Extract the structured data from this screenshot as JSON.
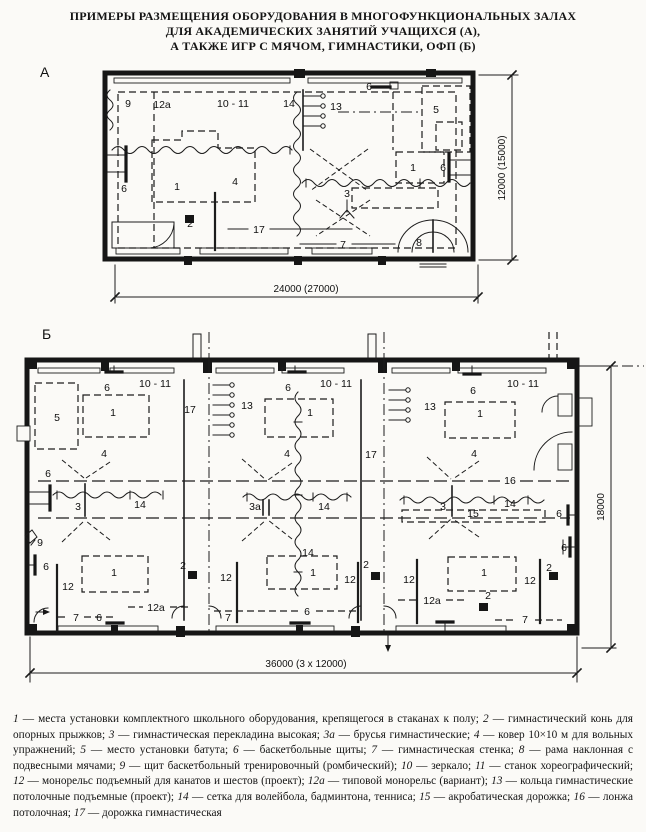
{
  "colors": {
    "ink": "#1c1c1c",
    "paper": "#fbfaf7"
  },
  "title": {
    "line1": "ПРИМЕРЫ РАЗМЕЩЕНИЯ ОБОРУДОВАНИЯ В МНОГОФУНКЦИОНАЛЬНЫХ ЗАЛАХ",
    "line2": "ДЛЯ АКАДЕМИЧЕСКИХ ЗАНЯТИЙ УЧАЩИХСЯ (А),",
    "line3": "А ТАКЖЕ ИГР С МЯЧОМ, ГИМНАСТИКИ, ОФП (Б)"
  },
  "plan_a": {
    "letter": "А",
    "dim_bottom": "24000 (27000)",
    "dim_right": "12000 (15000)",
    "labels": [
      {
        "t": "9",
        "x": 128,
        "y": 107
      },
      {
        "t": "12a",
        "x": 162,
        "y": 108
      },
      {
        "t": "10 - 11",
        "x": 233,
        "y": 107
      },
      {
        "t": "14",
        "x": 289,
        "y": 107
      },
      {
        "t": "13",
        "x": 336,
        "y": 110
      },
      {
        "t": "6",
        "x": 369,
        "y": 90
      },
      {
        "t": "5",
        "x": 436,
        "y": 113
      },
      {
        "t": "6",
        "x": 124,
        "y": 192
      },
      {
        "t": "1",
        "x": 177,
        "y": 190
      },
      {
        "t": "4",
        "x": 235,
        "y": 185
      },
      {
        "t": "3",
        "x": 347,
        "y": 197
      },
      {
        "t": "1",
        "x": 413,
        "y": 171
      },
      {
        "t": "6",
        "x": 443,
        "y": 171
      },
      {
        "t": "2",
        "x": 190,
        "y": 227
      },
      {
        "t": "17",
        "x": 259,
        "y": 233
      },
      {
        "t": "7",
        "x": 343,
        "y": 248
      },
      {
        "t": "8",
        "x": 419,
        "y": 246
      }
    ]
  },
  "plan_b": {
    "letter": "Б",
    "dim_bottom": "36000 (3 x 12000)",
    "dim_right": "18000",
    "labels": [
      {
        "t": "6",
        "x": 107,
        "y": 391
      },
      {
        "t": "10 - 11",
        "x": 155,
        "y": 387
      },
      {
        "t": "5",
        "x": 57,
        "y": 421
      },
      {
        "t": "1",
        "x": 113,
        "y": 416
      },
      {
        "t": "17",
        "x": 190,
        "y": 413
      },
      {
        "t": "4",
        "x": 104,
        "y": 457
      },
      {
        "t": "6",
        "x": 48,
        "y": 477
      },
      {
        "t": "3",
        "x": 78,
        "y": 510
      },
      {
        "t": "14",
        "x": 140,
        "y": 508
      },
      {
        "t": "9",
        "x": 40,
        "y": 546
      },
      {
        "t": "6",
        "x": 46,
        "y": 570
      },
      {
        "t": "12",
        "x": 68,
        "y": 590
      },
      {
        "t": "1",
        "x": 114,
        "y": 576
      },
      {
        "t": "12a",
        "x": 156,
        "y": 611
      },
      {
        "t": "7",
        "x": 76,
        "y": 621
      },
      {
        "t": "6",
        "x": 99,
        "y": 621
      },
      {
        "t": "13",
        "x": 247,
        "y": 409
      },
      {
        "t": "6",
        "x": 288,
        "y": 391
      },
      {
        "t": "10 - 11",
        "x": 336,
        "y": 387
      },
      {
        "t": "1",
        "x": 310,
        "y": 416
      },
      {
        "t": "4",
        "x": 287,
        "y": 457
      },
      {
        "t": "17",
        "x": 371,
        "y": 458
      },
      {
        "t": "3а",
        "x": 255,
        "y": 510
      },
      {
        "t": "14",
        "x": 324,
        "y": 510
      },
      {
        "t": "2",
        "x": 183,
        "y": 569
      },
      {
        "t": "12",
        "x": 226,
        "y": 581
      },
      {
        "t": "14",
        "x": 308,
        "y": 556
      },
      {
        "t": "1",
        "x": 313,
        "y": 576
      },
      {
        "t": "2",
        "x": 366,
        "y": 568
      },
      {
        "t": "12",
        "x": 350,
        "y": 583
      },
      {
        "t": "12a",
        "x": 432,
        "y": 604
      },
      {
        "t": "7",
        "x": 228,
        "y": 621
      },
      {
        "t": "6",
        "x": 307,
        "y": 615
      },
      {
        "t": "13",
        "x": 430,
        "y": 410
      },
      {
        "t": "6",
        "x": 473,
        "y": 394
      },
      {
        "t": "10 - 11",
        "x": 523,
        "y": 387
      },
      {
        "t": "1",
        "x": 480,
        "y": 417
      },
      {
        "t": "4",
        "x": 474,
        "y": 457
      },
      {
        "t": "16",
        "x": 510,
        "y": 484
      },
      {
        "t": "3",
        "x": 443,
        "y": 510
      },
      {
        "t": "15",
        "x": 473,
        "y": 517
      },
      {
        "t": "14",
        "x": 510,
        "y": 507
      },
      {
        "t": "6",
        "x": 559,
        "y": 517
      },
      {
        "t": "6",
        "x": 564,
        "y": 551
      },
      {
        "t": "12",
        "x": 409,
        "y": 583
      },
      {
        "t": "1",
        "x": 484,
        "y": 576
      },
      {
        "t": "2",
        "x": 488,
        "y": 599
      },
      {
        "t": "12",
        "x": 530,
        "y": 584
      },
      {
        "t": "2",
        "x": 549,
        "y": 571
      },
      {
        "t": "7",
        "x": 525,
        "y": 623
      }
    ]
  },
  "legend": {
    "items": [
      {
        "num": "1",
        "text": "места установки комплектного школьного оборудования, крепящегося в стаканах к полу"
      },
      {
        "num": "2",
        "text": "гимнастический конь для опорных прыжков"
      },
      {
        "num": "3",
        "text": "гимнастическая перекладина высокая"
      },
      {
        "num": "3а",
        "text": "брусья гимнастические"
      },
      {
        "num": "4",
        "text": "ковер 10×10 м для вольных упражнений"
      },
      {
        "num": "5",
        "text": "место установки батута"
      },
      {
        "num": "6",
        "text": "баскетбольные щиты"
      },
      {
        "num": "7",
        "text": "гимнастическая стенка"
      },
      {
        "num": "8",
        "text": "рама наклонная с подвесными мячами"
      },
      {
        "num": "9",
        "text": "щит баскетбольный тренировочный (ромбический)"
      },
      {
        "num": "10",
        "text": "зеркало"
      },
      {
        "num": "11",
        "text": "станок хореографический"
      },
      {
        "num": "12",
        "text": "монорельс подъемный для канатов и шестов (проект)"
      },
      {
        "num": "12а",
        "text": "типовой монорельс (вариант)"
      },
      {
        "num": "13",
        "text": "кольца гимнастические потолочные подъемные (проект)"
      },
      {
        "num": "14",
        "text": "сетка для волейбола, бадминтона, тенниса"
      },
      {
        "num": "15",
        "text": "акробатическая дорожка"
      },
      {
        "num": "16",
        "text": "лонжа потолочная"
      },
      {
        "num": "17",
        "text": "дорожка гимнастическая"
      }
    ]
  }
}
